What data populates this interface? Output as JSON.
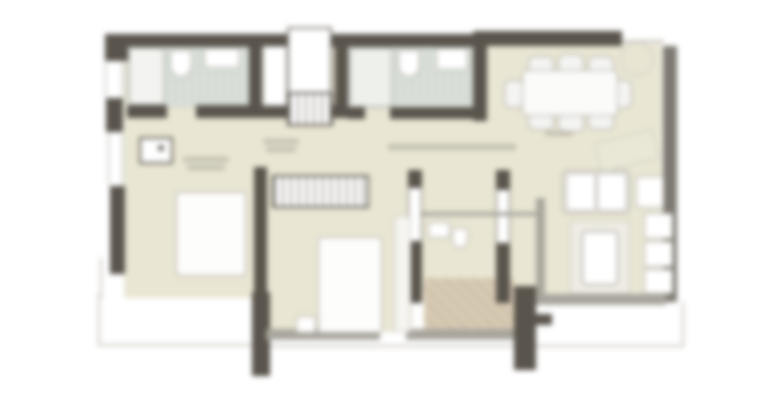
{
  "image": {
    "type": "architectural-floor-plan",
    "style": "blurred screenshot, no legible text labels",
    "orientation": "plan view"
  },
  "palette": {
    "wall_dark": "#59544c",
    "wall_medium": "#7e7a72",
    "wall_light": "#a8a59d",
    "floor_beige": "#e9e6d3",
    "tile_green": "#dde3dc",
    "entry_tan": "#d7cab3",
    "line_faint": "#c9c6be",
    "smudge": "#a39f94",
    "white": "#ffffff"
  },
  "rooms": [
    {
      "name": "bathroom-1",
      "position": "top-left",
      "finish": "green-grey tile"
    },
    {
      "name": "utility-closet-and-shaft",
      "position": "top-center-left"
    },
    {
      "name": "bathroom-2",
      "position": "top-center",
      "finish": "green-grey tile"
    },
    {
      "name": "dining-area",
      "position": "top-right"
    },
    {
      "name": "bedroom-left",
      "position": "mid-left"
    },
    {
      "name": "master-bedroom",
      "position": "center"
    },
    {
      "name": "water-closet",
      "position": "center-right of master"
    },
    {
      "name": "entry-foyer",
      "position": "bottom-center",
      "finish": "tan"
    },
    {
      "name": "living-area",
      "position": "right"
    },
    {
      "name": "balcony-left",
      "position": "bottom-left"
    },
    {
      "name": "balcony-right",
      "position": "bottom-right"
    }
  ],
  "furniture": {
    "dining_table": 1,
    "dining_chairs": 8,
    "beds": 2,
    "wardrobe_units": 2,
    "sofa_cushions": 2,
    "living_console_modules": 3,
    "coffee_table": 1,
    "plant": 1
  },
  "labels": {
    "note": "room labels present in source are blurred beyond legibility; rendered as grey smudges",
    "smudge_count": 6
  }
}
